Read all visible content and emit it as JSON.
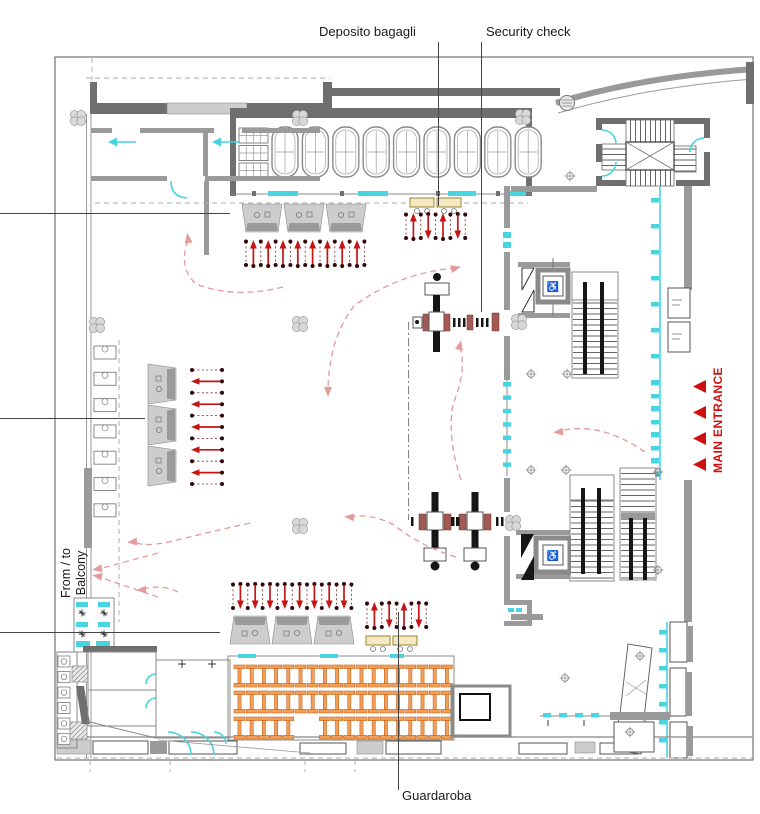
{
  "labels": {
    "deposito_bagagli": "Deposito bagagli",
    "security_check": "Security check",
    "guardaroba": "Guardaroba",
    "balcony_line1": "From / to",
    "balcony_line2": "Balcony",
    "main_entrance": "MAIN ENTRANCE"
  },
  "colors": {
    "wall_dark": "#6f6f6f",
    "wall_mid": "#9a9a9a",
    "wall_light": "#cdcdcd",
    "door_glazing": "#48d4e0",
    "furniture_orange": "#f0a058",
    "flow_arrow_red": "#c41414",
    "queue_dot": "#33090b",
    "gate_post_maroon": "#a35a54",
    "table_beige": "#f4e9c5",
    "circulation_pink": "#e39b9b",
    "entrance_red": "#d01010"
  },
  "plan_elements": {
    "type": "floor-plan",
    "luggage_shelving_units": 9,
    "locker_cabinet_blocks": 3,
    "deposit_counters_top": 3,
    "deposit_tables": 2,
    "ticket_desks_left": 3,
    "cloakroom_counters_bottom": 3,
    "cloakroom_tables": 2,
    "coat_rack_rows": 3,
    "security_gate_rows": 2,
    "turnstile_gates": 3,
    "staircases": 4,
    "elevators": 2,
    "main_entrance_arrows": 4,
    "structural_columns": 8
  }
}
